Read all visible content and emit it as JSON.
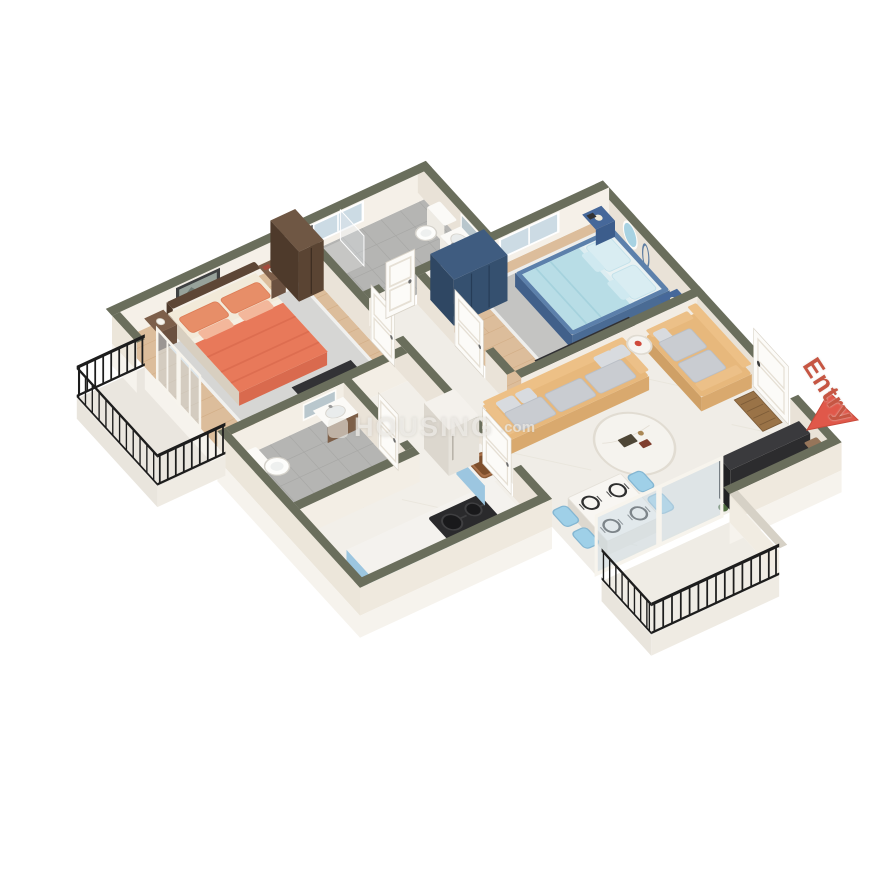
{
  "canvas": {
    "width": 870,
    "height": 870,
    "background": "#ffffff"
  },
  "scene": {
    "type": "isometric-3d-floor-plan",
    "description": "3D cutaway render of a two-bedroom apartment with two bathrooms, kitchen, living/dining room and two balconies"
  },
  "watermark": {
    "text": "HOUSING",
    "suffix": ".com"
  },
  "entry_marker": {
    "label": "Entry",
    "label_color": "#c65643",
    "arrow_color": "#e0584a"
  },
  "palette": {
    "wall_cut_top": "#6a6e5c",
    "wall_face_light": "#f5f0e8",
    "wall_face_shade": "#e9e2d7",
    "wood_floor": "#dcbd9b",
    "tile_floor": "#b5b5b3",
    "marble_floor": "#f0ede7",
    "master_bed_blanket": "#e8795a",
    "guest_bed_frame": "#5c80ab",
    "guest_bedding": "#b8dde6",
    "sofa": "#e7b87c",
    "kitchen_cabinet": "#a9d2ea",
    "wardrobe_brown": "#6f5744",
    "wardrobe_blue": "#3f5c80",
    "railing": "#1d1d1d",
    "accent_red": "#e0584a"
  },
  "rooms": [
    {
      "name": "Master Bedroom",
      "floor": "wood planks",
      "furniture": [
        "double bed with coral bedding and pillows",
        "dark wood headboard",
        "two wooden nightstands with lamps",
        "brown wardrobe",
        "framed wall art",
        "TV panel",
        "gray rug",
        "glass doors to balcony"
      ]
    },
    {
      "name": "Bathroom 1",
      "floor": "gray tile",
      "furniture": [
        "shower with glass partition",
        "window",
        "toilet",
        "washbasin",
        "mirror"
      ]
    },
    {
      "name": "Bedroom 2",
      "floor": "wood planks",
      "furniture": [
        "double bed with blue frame and light-blue bedding",
        "two blue nightstands",
        "blue wardrobe",
        "round wall mirror with hanging ring",
        "TV console",
        "gray rug",
        "window"
      ]
    },
    {
      "name": "Living / Dining Room",
      "floor": "marble",
      "furniture": [
        "two yellow sofas with gray cushions",
        "round coffee table",
        "round side table",
        "dining table with four place settings",
        "four blue chairs",
        "television",
        "doormat",
        "entry door",
        "sliding glass doors to balcony"
      ]
    },
    {
      "name": "Kitchen",
      "floor": "marble",
      "furniture": [
        "light-blue base cabinets with white counter",
        "gas hob with two pots",
        "copper sink",
        "refrigerator"
      ]
    },
    {
      "name": "Bathroom 2",
      "floor": "gray tile",
      "furniture": [
        "toilet",
        "washbasin on wood base",
        "mirror"
      ]
    },
    {
      "name": "Balcony 1",
      "floor": "stone",
      "furniture": [
        "black iron railing"
      ]
    },
    {
      "name": "Balcony 2",
      "floor": "stone",
      "furniture": [
        "black iron railing"
      ]
    }
  ]
}
